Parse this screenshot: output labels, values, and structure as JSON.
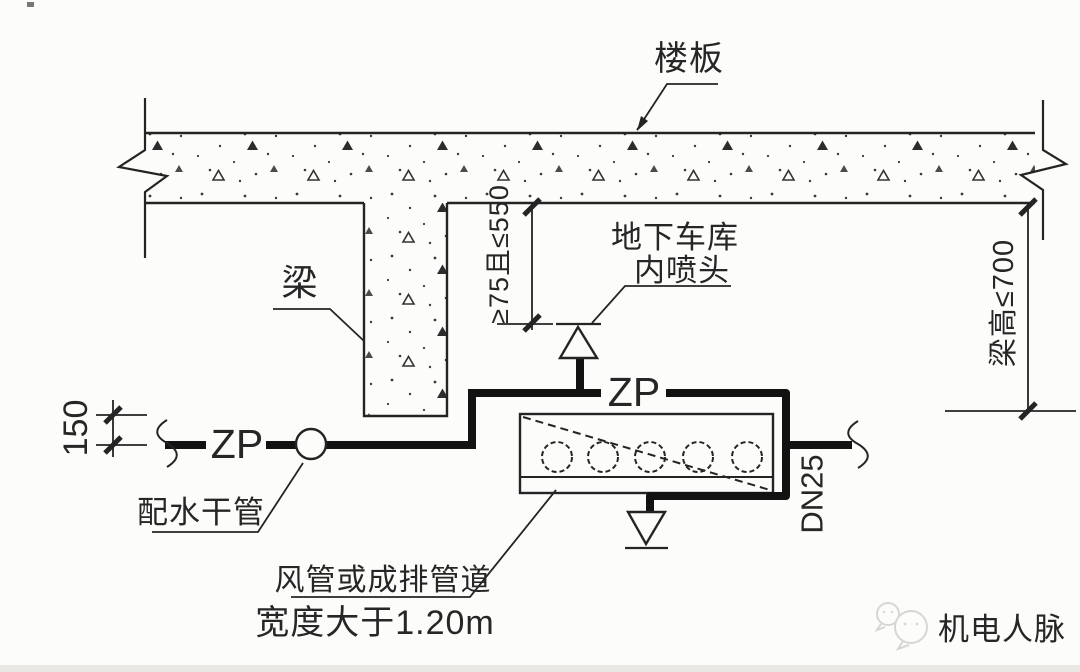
{
  "diagram": {
    "labels": {
      "slab": "楼板",
      "beam": "梁",
      "garage_sprinkler_line1": "地下车库",
      "garage_sprinkler_line2": "内喷头",
      "distribution_main": "配水干管",
      "duct_note_line1": "风管或成排管道",
      "duct_note_line2": "宽度大于1.20m",
      "pipe_code_left": "ZP",
      "pipe_code_top": "ZP",
      "branch_pipe_size": "DN25"
    },
    "dimensions": {
      "riser_drop": "150",
      "deflector_distance": "≥75且≤550",
      "beam_height_limit": "梁高≤700"
    },
    "watermark": {
      "text": "机电人脉",
      "color": "#d7d6d3"
    },
    "colors": {
      "line": "#242424",
      "pipe": "#121212",
      "background": "#fcfcfb"
    }
  }
}
